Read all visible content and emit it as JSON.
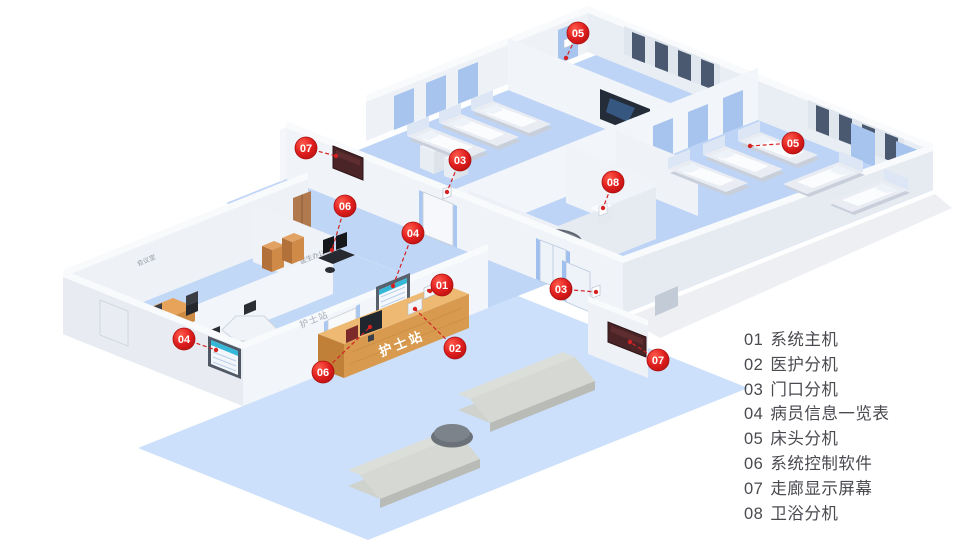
{
  "legend": {
    "items": [
      {
        "num": "01",
        "label": "系统主机"
      },
      {
        "num": "02",
        "label": "医护分机"
      },
      {
        "num": "03",
        "label": "门口分机"
      },
      {
        "num": "04",
        "label": "病员信息一览表"
      },
      {
        "num": "05",
        "label": "床头分机"
      },
      {
        "num": "06",
        "label": "系统控制软件"
      },
      {
        "num": "07",
        "label": "走廊显示屏幕"
      },
      {
        "num": "08",
        "label": "卫浴分机"
      }
    ]
  },
  "callouts": [
    {
      "n": "05"
    },
    {
      "n": "07"
    },
    {
      "n": "03"
    },
    {
      "n": "06"
    },
    {
      "n": "08"
    },
    {
      "n": "05"
    },
    {
      "n": "04"
    },
    {
      "n": "01"
    },
    {
      "n": "03"
    },
    {
      "n": "02"
    },
    {
      "n": "04"
    },
    {
      "n": "06"
    },
    {
      "n": "07"
    }
  ],
  "labels": {
    "nurse_station_counter": "护士站",
    "nurse_station_wall": "护士站",
    "meeting_room": "会议室",
    "nursing_dept": "护理部",
    "doctor_office": "医生办公室"
  },
  "colors": {
    "badge_red": "#e01f1f",
    "leader_line": "#d42222",
    "floor_blue": "#c3d9f8",
    "lobby_blue": "#cce0fb",
    "wall_white": "#f0f3f8",
    "accent_blue": "#a9c7f0",
    "counter_wood": "#d89a4e",
    "corridor_display": "#4a2426",
    "info_board_header": "#35b8d8",
    "legend_text": "#4a4a50"
  }
}
